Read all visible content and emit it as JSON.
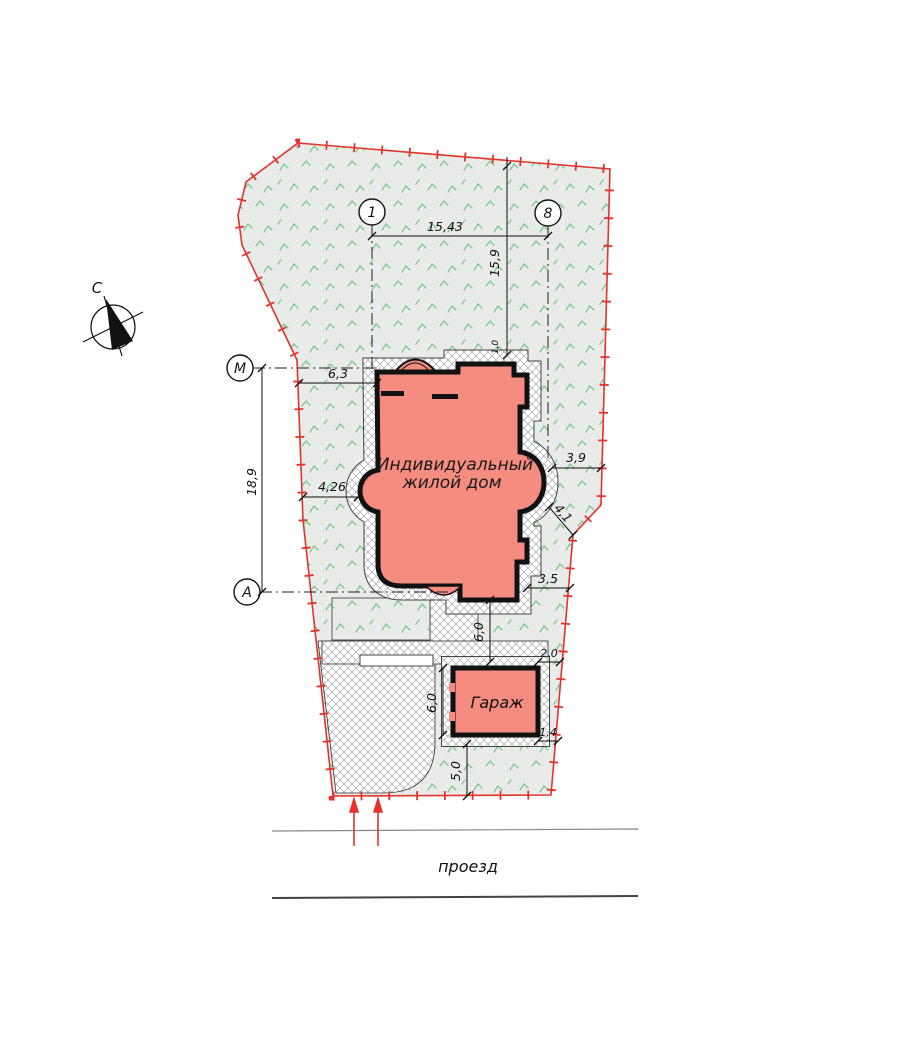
{
  "plan": {
    "north_label": "С",
    "axes": {
      "a1": "1",
      "a8": "8",
      "am": "М",
      "aa": "А"
    },
    "labels": {
      "house_line1": "Индивидуальный",
      "house_line2": "жилой дом",
      "garage": "Гараж",
      "road": "проезд"
    },
    "dims": {
      "axis_width": "15,43",
      "north_offset": "15,9",
      "axis_height": "18,9",
      "west_offset": "6,3",
      "west_bay_offset": "4,26",
      "east_bay_offset": "3,9",
      "east_corner_offset": "4,1",
      "southeast_offset": "3,5",
      "house_to_garage": "6,0",
      "garage_side": "6,0",
      "garage_east_top": "2,0",
      "garage_east_bottom": "1,4",
      "south_offset": "5,0",
      "top_wall_offset": "1,0"
    },
    "colors": {
      "boundary_red": "#e2342b",
      "house_fill": "#f48c80",
      "grass_green": "#7cc791",
      "site_bg": "#e9ebe8",
      "wall_black": "#111111"
    }
  }
}
